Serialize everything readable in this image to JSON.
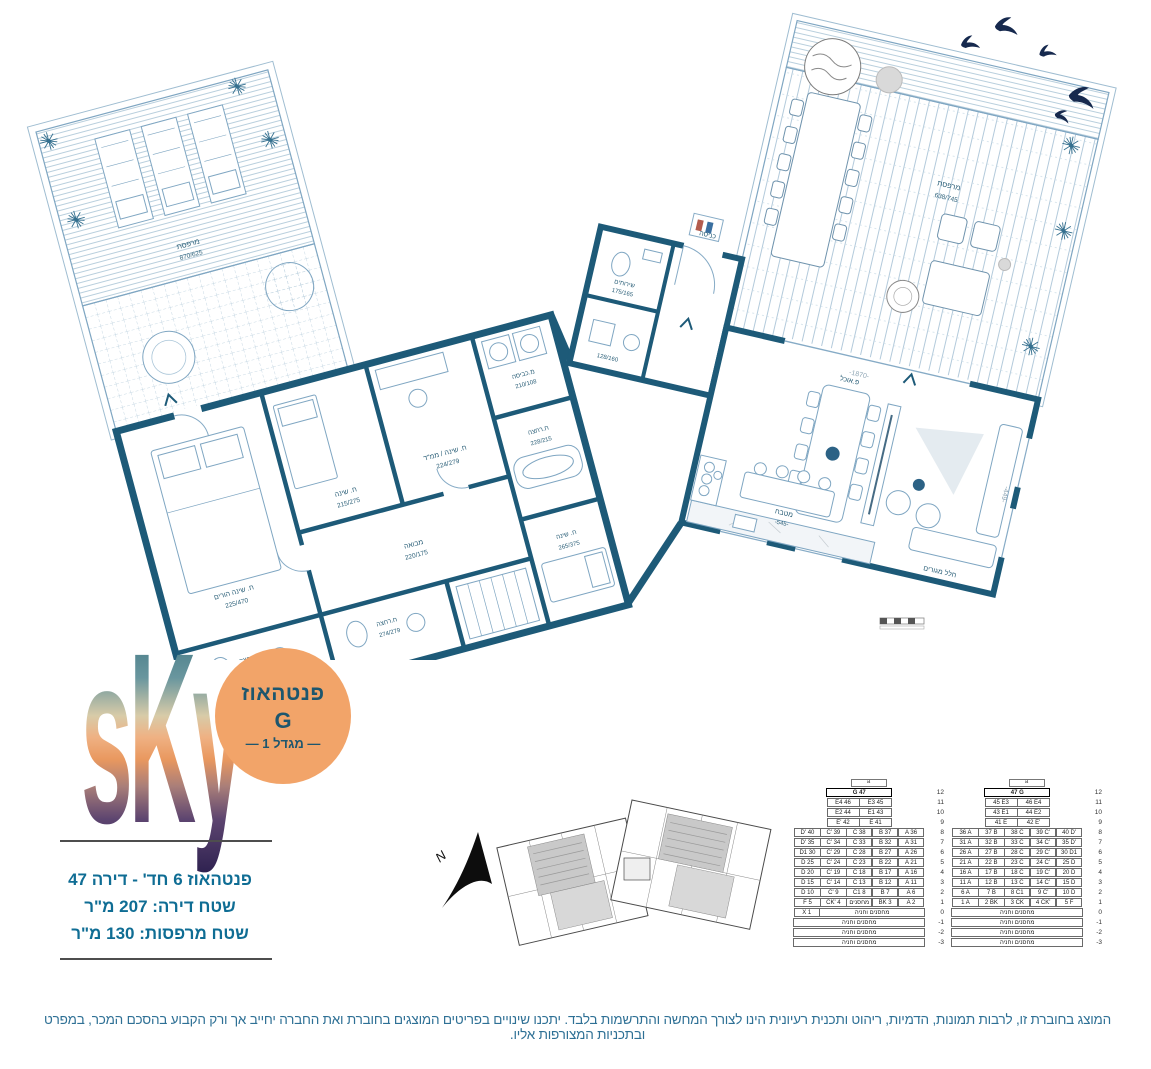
{
  "colors": {
    "wall_teal": "#1d5a78",
    "detail_blue": "#86abc6",
    "badge_orange": "#f2a469",
    "text_teal": "#0f6d94",
    "bird_navy": "#16294e"
  },
  "plan": {
    "compass": "N",
    "dims": {
      "d1": "-1870-",
      "d2": "-449-"
    },
    "rooms": [
      {
        "label": "מרפסת",
        "dims": "870/625"
      },
      {
        "label": "מרפסת",
        "dims": "638/745"
      },
      {
        "label": "ח. שינה הורים",
        "dims": "225/470"
      },
      {
        "label": "ח. שינה",
        "dims": "215/275"
      },
      {
        "label": "ח. שינה / ממ\"ד",
        "dims": "224/279"
      },
      {
        "label": "מ.כביסה",
        "dims": "210/108"
      },
      {
        "label": "מבואה",
        "dims": "220/175"
      },
      {
        "label": "ח.רחצה",
        "dims": "200/190"
      },
      {
        "label": "ח.רחצה",
        "dims": "274/279"
      },
      {
        "label": "ח.רחצה",
        "dims": "228/215"
      },
      {
        "label": "ח. שינה",
        "dims": "265/375"
      },
      {
        "label": "שירותים",
        "dims": "175/165"
      },
      {
        "label": "",
        "dims": "128/160"
      },
      {
        "label": "כניסה",
        "dims": ""
      },
      {
        "label": "פ.אוכל",
        "dims": ""
      },
      {
        "label": "מטבח",
        "dims": "-545-"
      },
      {
        "label": "חלל מגורים",
        "dims": ""
      }
    ]
  },
  "logo": {
    "wordmark": "sKy"
  },
  "badge": {
    "line1": "פנטהאוז",
    "line2": "G",
    "line3": "— מגדל 1 —"
  },
  "summary": {
    "line1": "פנטהאוז 6 חד' - דירה 47",
    "line2": "שטח דירה: 207 מ\"ר",
    "line3": "שטח מרפסות: 130 מ\"ר"
  },
  "stack_tables": {
    "left": {
      "header": "a",
      "rows": [
        {
          "floor": "12",
          "hl": true,
          "cells": [
            {
              "t": "G 47",
              "u": 2.5
            }
          ]
        },
        {
          "floor": "11",
          "cells": [
            {
              "t": "E4 46",
              "u": 1.25
            },
            {
              "t": "E3 45",
              "u": 1.25
            }
          ]
        },
        {
          "floor": "10",
          "cells": [
            {
              "t": "E2 44",
              "u": 1.25
            },
            {
              "t": "E1 43",
              "u": 1.25
            }
          ]
        },
        {
          "floor": "9",
          "cells": [
            {
              "t": "E' 42",
              "u": 1.25
            },
            {
              "t": "E 41",
              "u": 1.25
            }
          ]
        },
        {
          "floor": "8",
          "cells": [
            {
              "t": "D' 40"
            },
            {
              "t": "C' 39"
            },
            {
              "t": "C 38"
            },
            {
              "t": "B 37"
            },
            {
              "t": "A 36"
            }
          ]
        },
        {
          "floor": "7",
          "cells": [
            {
              "t": "D' 35"
            },
            {
              "t": "C' 34"
            },
            {
              "t": "C 33"
            },
            {
              "t": "B 32"
            },
            {
              "t": "A 31"
            }
          ]
        },
        {
          "floor": "6",
          "cells": [
            {
              "t": "D1 30"
            },
            {
              "t": "C' 29"
            },
            {
              "t": "C 28"
            },
            {
              "t": "B 27"
            },
            {
              "t": "A 26"
            }
          ]
        },
        {
          "floor": "5",
          "cells": [
            {
              "t": "D 25"
            },
            {
              "t": "C' 24"
            },
            {
              "t": "C 23"
            },
            {
              "t": "B 22"
            },
            {
              "t": "A 21"
            }
          ]
        },
        {
          "floor": "4",
          "cells": [
            {
              "t": "D 20"
            },
            {
              "t": "C' 19"
            },
            {
              "t": "C 18"
            },
            {
              "t": "B 17"
            },
            {
              "t": "A 16"
            }
          ]
        },
        {
          "floor": "3",
          "cells": [
            {
              "t": "D 15"
            },
            {
              "t": "C' 14"
            },
            {
              "t": "C 13"
            },
            {
              "t": "B 12"
            },
            {
              "t": "A 11"
            }
          ]
        },
        {
          "floor": "2",
          "cells": [
            {
              "t": "D 10"
            },
            {
              "t": "C' 9"
            },
            {
              "t": "C1 8"
            },
            {
              "t": "B 7"
            },
            {
              "t": "A 6"
            }
          ]
        },
        {
          "floor": "1",
          "cells": [
            {
              "t": "F 5"
            },
            {
              "t": "CK' 4"
            },
            {
              "t": "מחסנים"
            },
            {
              "t": "BK 3"
            },
            {
              "t": "A 2"
            }
          ]
        },
        {
          "floor": "0",
          "cells": [
            {
              "t": "X 1",
              "u": 1
            },
            {
              "t": "מחסנים וחניה",
              "u": 4
            }
          ]
        },
        {
          "floor": "-1",
          "cells": [
            {
              "t": "מחסנים וחניה",
              "u": 5
            }
          ]
        },
        {
          "floor": "-2",
          "cells": [
            {
              "t": "מחסנים וחניה",
              "u": 5
            }
          ]
        },
        {
          "floor": "-3",
          "cells": [
            {
              "t": "מחסנים וחניה",
              "u": 5
            }
          ]
        }
      ]
    },
    "right": {
      "header": "a",
      "rows": [
        {
          "floor": "12",
          "hl": true,
          "cells": [
            {
              "t": "47 G",
              "u": 2.5
            }
          ]
        },
        {
          "floor": "11",
          "cells": [
            {
              "t": "45 E3",
              "u": 1.25
            },
            {
              "t": "46 E4",
              "u": 1.25
            }
          ]
        },
        {
          "floor": "10",
          "cells": [
            {
              "t": "43 E1",
              "u": 1.25
            },
            {
              "t": "44 E2",
              "u": 1.25
            }
          ]
        },
        {
          "floor": "9",
          "cells": [
            {
              "t": "41 E",
              "u": 1.25
            },
            {
              "t": "42 E'",
              "u": 1.25
            }
          ]
        },
        {
          "floor": "8",
          "cells": [
            {
              "t": "36 A"
            },
            {
              "t": "37 B"
            },
            {
              "t": "38 C"
            },
            {
              "t": "39 C'"
            },
            {
              "t": "40 D'"
            }
          ]
        },
        {
          "floor": "7",
          "cells": [
            {
              "t": "31 A"
            },
            {
              "t": "32 B"
            },
            {
              "t": "33 C"
            },
            {
              "t": "34 C'"
            },
            {
              "t": "35 D'"
            }
          ]
        },
        {
          "floor": "6",
          "cells": [
            {
              "t": "26 A"
            },
            {
              "t": "27 B"
            },
            {
              "t": "28 C"
            },
            {
              "t": "29 C'"
            },
            {
              "t": "30 D1"
            }
          ]
        },
        {
          "floor": "5",
          "cells": [
            {
              "t": "21 A"
            },
            {
              "t": "22 B"
            },
            {
              "t": "23 C"
            },
            {
              "t": "24 C'"
            },
            {
              "t": "25 D"
            }
          ]
        },
        {
          "floor": "4",
          "cells": [
            {
              "t": "16 A"
            },
            {
              "t": "17 B"
            },
            {
              "t": "18 C"
            },
            {
              "t": "19 C'"
            },
            {
              "t": "20 D"
            }
          ]
        },
        {
          "floor": "3",
          "cells": [
            {
              "t": "11 A"
            },
            {
              "t": "12 B"
            },
            {
              "t": "13 C"
            },
            {
              "t": "14 C'"
            },
            {
              "t": "15 D"
            }
          ]
        },
        {
          "floor": "2",
          "cells": [
            {
              "t": "6 A"
            },
            {
              "t": "7 B"
            },
            {
              "t": "8 C1"
            },
            {
              "t": "9 C'"
            },
            {
              "t": "10 D"
            }
          ]
        },
        {
          "floor": "1",
          "cells": [
            {
              "t": "1 A"
            },
            {
              "t": "2 BK"
            },
            {
              "t": "3 CK"
            },
            {
              "t": "4 CK'"
            },
            {
              "t": "5 F"
            }
          ]
        },
        {
          "floor": "0",
          "cells": [
            {
              "t": "מחסנים וחניה",
              "u": 5
            }
          ]
        },
        {
          "floor": "-1",
          "cells": [
            {
              "t": "מחסנים וחניה",
              "u": 5
            }
          ]
        },
        {
          "floor": "-2",
          "cells": [
            {
              "t": "מחסנים וחניה",
              "u": 5
            }
          ]
        },
        {
          "floor": "-3",
          "cells": [
            {
              "t": "מחסנים וחניה",
              "u": 5
            }
          ]
        }
      ]
    }
  },
  "disclaimer": "המוצג בחוברת זו, לרבות תמונות, הדמיות, ריהוט ותכנית רעיונית הינו לצורך המחשה והתרשמות בלבד. יתכנו שינויים בפריטים המוצגים בחוברת ואת החברה יחייב אך ורק הקבוע בהסכם המכר, במפרט ובתכניות המצורפות אליו."
}
